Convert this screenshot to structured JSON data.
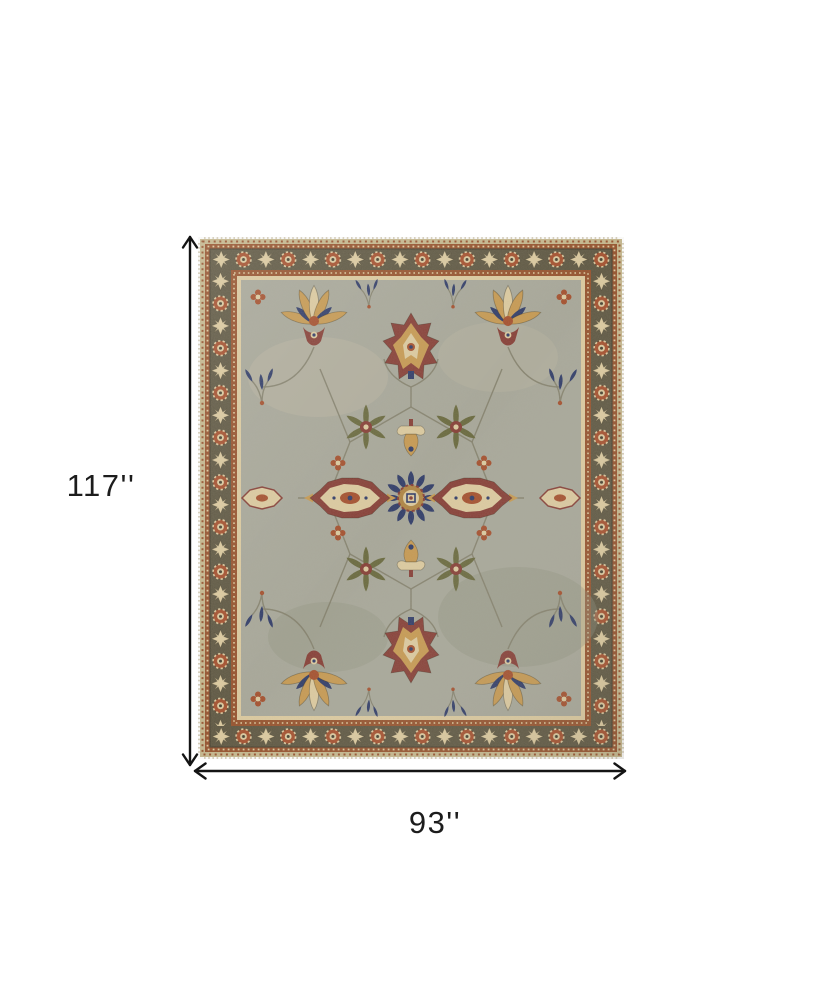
{
  "figure": {
    "alt": "ornate traditional area rug shown flat",
    "height_label": "117''",
    "width_label": "93''"
  },
  "colors": {
    "background": "#ffffff",
    "dimension_line": "#141414",
    "label_text": "#1c1c1c",
    "field": "#a8a89a",
    "field_light": "#bcb6a4",
    "field_shade": "#90917e",
    "border_olive": "#5e5742",
    "border_olive_dark": "#453f2f",
    "guard_rust": "#96522d",
    "cream": "#ddcba0",
    "cream_dark": "#c6b88e",
    "gold": "#c79a52",
    "tan": "#b08644",
    "navy": "#303c69",
    "burgundy": "#873f37",
    "red_rust": "#a5502e",
    "olive_leaf": "#6a6a3f",
    "vine": "#83806c",
    "fringe": "#d8d0bd"
  }
}
